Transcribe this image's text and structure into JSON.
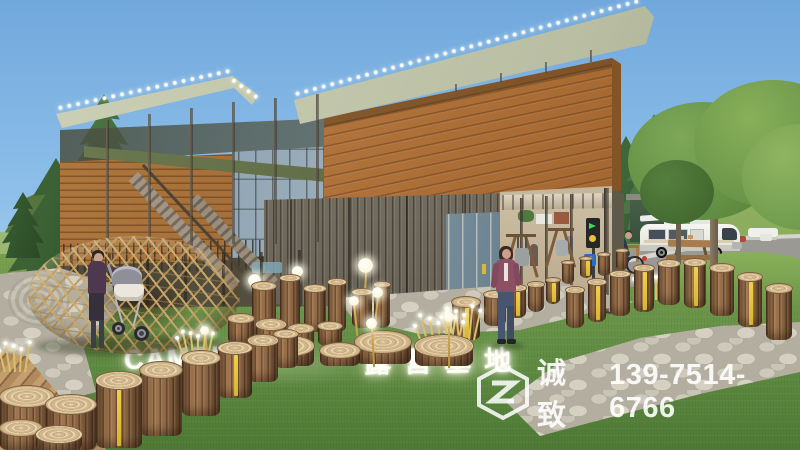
{
  "signage": {
    "camping_en": "CAMPING",
    "camping_zh": "露营基地"
  },
  "watermark": {
    "brand": "诚致",
    "phone": "139-7514-6766",
    "logo": "hexagon-z-logo"
  },
  "signs": {
    "parking": "P"
  },
  "palette": {
    "sky": "#79aede",
    "grass": "#639044",
    "wood_facade": "#b1753c",
    "container": "#7d7668",
    "roof": "#c4c8ae",
    "hill": "#86a65c",
    "stone_path": "#c9c5b8",
    "log_stump": "#9c7550",
    "stripe_yellow": "#e6c43c",
    "glow_text": "#ffffff"
  }
}
